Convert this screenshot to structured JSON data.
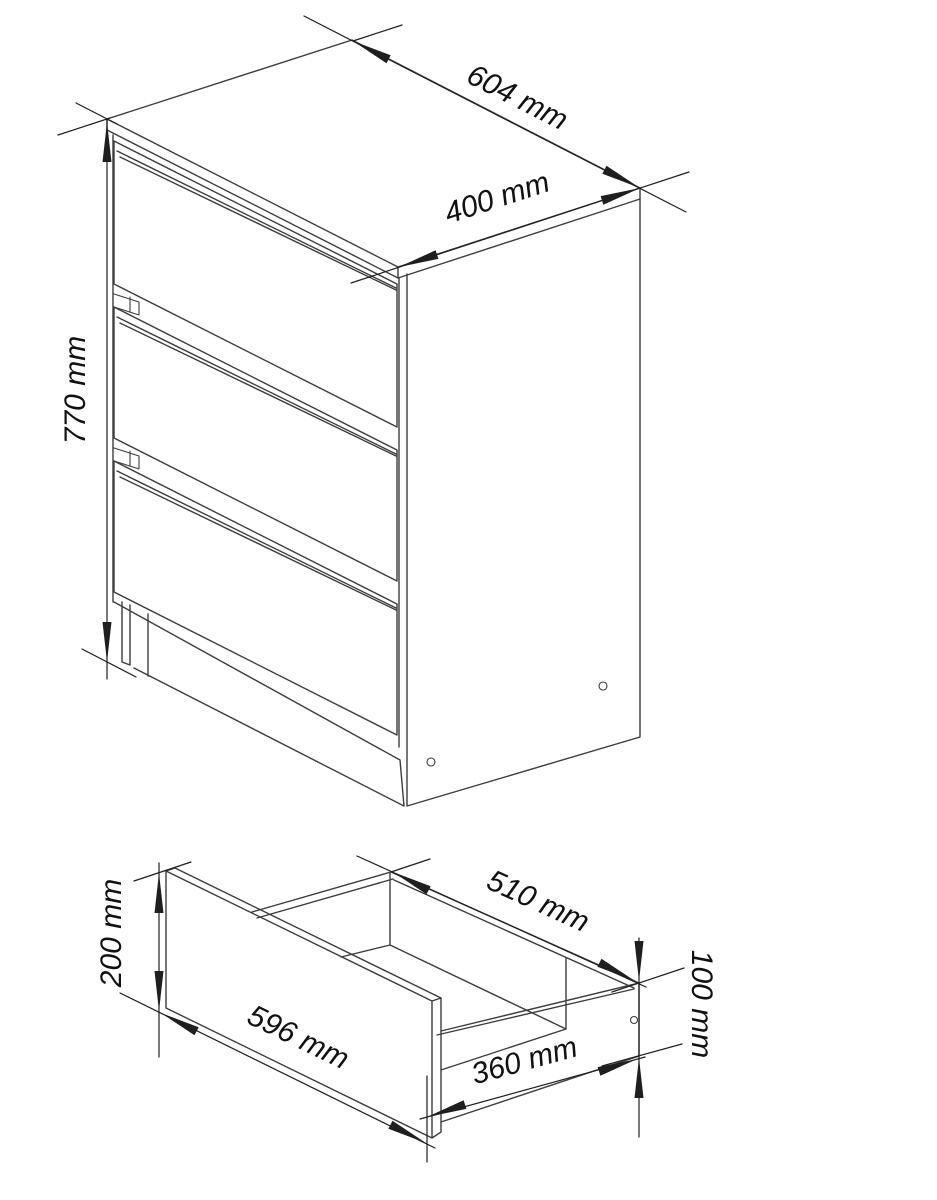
{
  "labels": {
    "cabinet": {
      "height": "770 mm",
      "depth": "604 mm",
      "width": "400 mm"
    },
    "drawer": {
      "front_height": "200 mm",
      "front_width": "596 mm",
      "inner_width": "510 mm",
      "depth": "360 mm",
      "side_height": "100 mm"
    }
  },
  "colors": {
    "background": "#ffffff",
    "line": "#3d3d3d",
    "dim": "#1f1f1f",
    "text": "#111111"
  }
}
